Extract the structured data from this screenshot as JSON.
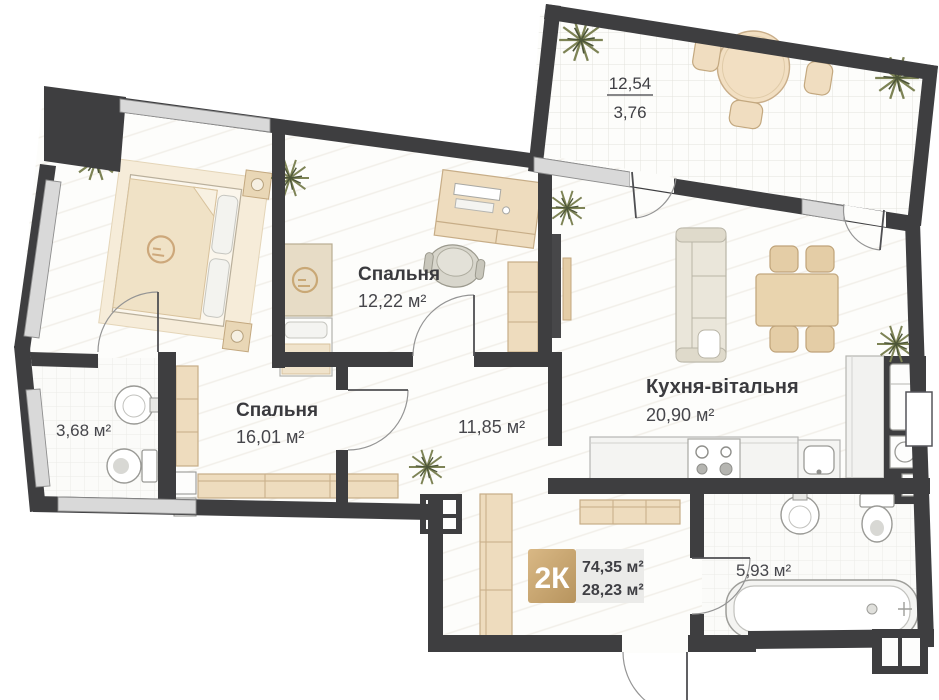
{
  "plan": {
    "terrace": {
      "value_top": "12,54",
      "value_bottom": "3,76"
    },
    "rooms": [
      {
        "key": "bedroom-small",
        "label": "Спальня",
        "area": "12,22 м²"
      },
      {
        "key": "bedroom-master",
        "label": "Спальня",
        "area": "16,01 м²"
      },
      {
        "key": "kitchen-living",
        "label": "Кухня-вітальня",
        "area": "20,90 м²"
      },
      {
        "key": "hallway",
        "label": "",
        "area": "11,85 м²"
      },
      {
        "key": "bathroom-small",
        "label": "",
        "area": "3,68 м²"
      },
      {
        "key": "bathroom-large",
        "label": "",
        "area": "5,93 м²"
      }
    ],
    "badge": {
      "type_label": "2К",
      "total_area": "74,35 м²",
      "living_area": "28,23 м²"
    },
    "colors": {
      "wall": "#3e3e40",
      "window": "#d9d9d9",
      "accent_tan": "#c8a06b",
      "floor": "#fdfdfb"
    }
  }
}
